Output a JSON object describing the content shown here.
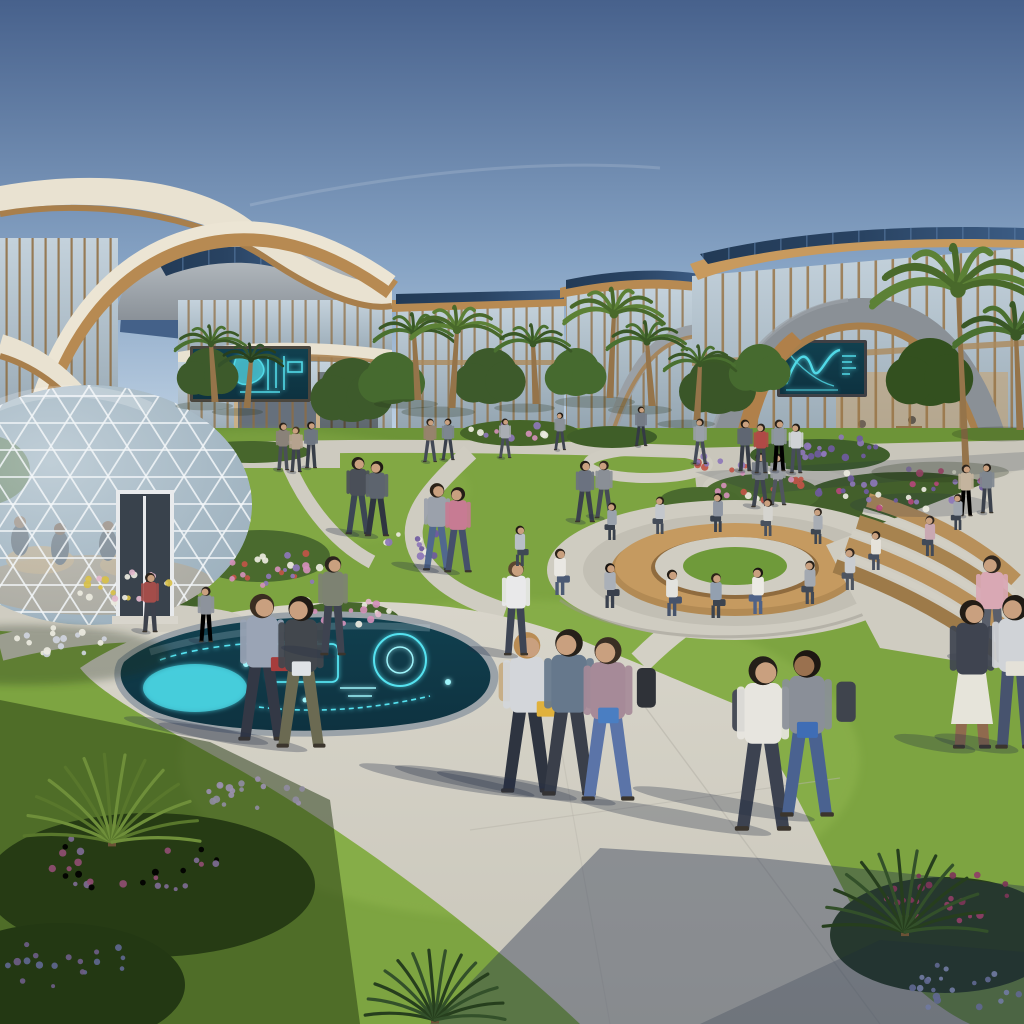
{
  "scene": {
    "alt": "Sunny futuristic university campus courtyard with curved wood-and-glass buildings, solar roofs, a geodesic glass dome, glowing cyan holographic displays, winding paths, a circular seating ring and students walking the green quad."
  },
  "palette": {
    "sky_top": "#47618c",
    "sky_mid": "#86a3c4",
    "sky_horizon": "#cdddeb",
    "wood": "#b78a52",
    "wood_dark": "#8f6a3c",
    "cream": "#e9e2d1",
    "roof_gray": "#a6acb2",
    "roof_gray_dark": "#878e95",
    "solar_dark": "#294362",
    "solar_line": "#55779f",
    "glass_light": "#c4d2dc",
    "glass_dark": "#93a4b0",
    "grass_sun": "#7da441",
    "grass_light": "#93b851",
    "grass_shade": "#3f5c24",
    "path_sun": "#d8d5ca",
    "path_mid": "#c7c4b9",
    "holo_bg": "#0e3240",
    "holo_cyan": "#55e2f0",
    "holo_bright": "#9ef4fb",
    "skin": "#c9a07f",
    "shadow_blue": "#232e44"
  },
  "people": [
    {
      "x": 527,
      "y": 792,
      "h": 162,
      "pose": "walk",
      "dir": 1,
      "top": "#d3d6da",
      "bottom": "#2e3440",
      "hair": "#b98c54",
      "item": "#e0b13c",
      "bag": "#c7ae86",
      "sh": 1
    },
    {
      "x": 569,
      "y": 795,
      "h": 168,
      "pose": "walk",
      "dir": -1,
      "top": "#66788c",
      "bottom": "#3a3f4a",
      "hair": "#26201a",
      "bag": "#3c4049",
      "sh": 1
    },
    {
      "x": 608,
      "y": 800,
      "h": 165,
      "pose": "walk",
      "dir": -1,
      "top": "#a68a98",
      "bottom": "#5b74a8",
      "hair": "#3a2e24",
      "item": "#4a7ec2",
      "bag": "#2f3238",
      "sh": 1
    },
    {
      "x": 763,
      "y": 830,
      "h": 176,
      "pose": "walk",
      "dir": 1,
      "top": "#e7e5df",
      "bottom": "#3c4250",
      "hair": "#241f19",
      "bag": "#474c57",
      "sh": 1
    },
    {
      "x": 807,
      "y": 816,
      "h": 168,
      "pose": "walk",
      "dir": -1,
      "top": "#8a8f98",
      "bottom": "#4a6290",
      "hair": "#1d1712",
      "skin": "#9a714f",
      "item": "#3f6db5",
      "bag": "#3f444d",
      "sh": 1
    },
    {
      "x": 262,
      "y": 740,
      "h": 148,
      "pose": "walk",
      "dir": 1,
      "top": "#9aa4b5",
      "bottom": "#333845",
      "hair": "#3a2d21",
      "item": "#a63c3c",
      "sh": 0.9
    },
    {
      "x": 301,
      "y": 747,
      "h": 153,
      "pose": "walk",
      "dir": -1,
      "top": "#42474d",
      "bottom": "#6b6a52",
      "hair": "#201b15",
      "item": "#dfe3e6",
      "sh": 0.9
    },
    {
      "x": 516,
      "y": 655,
      "h": 95,
      "pose": "stand",
      "dir": 1,
      "top": "#e9e9ea",
      "bottom": "#3e4554",
      "hair": "#5a4632",
      "sh": 0.5
    },
    {
      "x": 333,
      "y": 655,
      "h": 100,
      "pose": "stand",
      "dir": 1,
      "top": "#7d8272",
      "bottom": "#3e4350",
      "hair": "#2b241d",
      "sh": 0.5
    },
    {
      "x": 437,
      "y": 570,
      "h": 88,
      "pose": "walk",
      "dir": 1,
      "top": "#9ba1ab",
      "bottom": "#51688e",
      "hair": "#2a2118",
      "sh": 0.5
    },
    {
      "x": 458,
      "y": 572,
      "h": 86,
      "pose": "walk",
      "dir": -1,
      "top": "#c77b93",
      "bottom": "#45506b",
      "hair": "#241d17",
      "sh": 0.5
    },
    {
      "x": 358,
      "y": 534,
      "h": 78,
      "pose": "walk",
      "dir": 1,
      "top": "#4a4f58",
      "bottom": "#3c4654",
      "hair": "#241f18",
      "sh": 0.4
    },
    {
      "x": 377,
      "y": 536,
      "h": 76,
      "pose": "walk",
      "dir": -1,
      "top": "#5d646e",
      "bottom": "#2f3540",
      "hair": "#1f1a14",
      "sh": 0.4
    },
    {
      "x": 585,
      "y": 522,
      "h": 62,
      "pose": "walk",
      "dir": 1,
      "top": "#6b7280",
      "bottom": "#3b414c",
      "hair": "#221c15",
      "sh": 0.3
    },
    {
      "x": 604,
      "y": 518,
      "h": 58,
      "pose": "walk",
      "dir": -1,
      "top": "#8a8f96",
      "bottom": "#454b56",
      "hair": "#2c241c",
      "sh": 0.3
    },
    {
      "x": 760,
      "y": 507,
      "h": 55,
      "pose": "walk",
      "dir": 1,
      "top": "#7a8088",
      "bottom": "#3f454f",
      "hair": "#241e17",
      "sh": 0.3
    },
    {
      "x": 778,
      "y": 505,
      "h": 52,
      "pose": "walk",
      "dir": -1,
      "top": "#9a9ea4",
      "bottom": "#50555e",
      "hair": "#1d1812",
      "sh": 0.3
    },
    {
      "x": 283,
      "y": 470,
      "h": 48,
      "pose": "stand",
      "dir": 1,
      "top": "#8a8279",
      "bottom": "#4a4f58",
      "hair": "#2a231c",
      "sh": 0.2
    },
    {
      "x": 296,
      "y": 472,
      "h": 46,
      "pose": "stand",
      "dir": -1,
      "top": "#b5a28e",
      "bottom": "#3e434d",
      "hair": "#463724",
      "sh": 0.2
    },
    {
      "x": 311,
      "y": 468,
      "h": 47,
      "pose": "stand",
      "dir": 1,
      "top": "#6e7681",
      "bottom": "#383e48",
      "hair": "#211b14",
      "sh": 0.2
    },
    {
      "x": 430,
      "y": 462,
      "h": 44,
      "pose": "walk",
      "dir": 1,
      "top": "#97836d",
      "bottom": "#434956",
      "hair": "#2e251b",
      "sh": 0.2
    },
    {
      "x": 448,
      "y": 460,
      "h": 42,
      "pose": "walk",
      "dir": -1,
      "top": "#7d8690",
      "bottom": "#3a404b",
      "hair": "#241e16",
      "sh": 0.2
    },
    {
      "x": 505,
      "y": 458,
      "h": 40,
      "pose": "walk",
      "dir": 1,
      "top": "#a9adb3",
      "bottom": "#474d58",
      "hair": "#2a2119",
      "sh": 0.2
    },
    {
      "x": 560,
      "y": 450,
      "h": 38,
      "pose": "walk",
      "dir": -1,
      "top": "#8b9199",
      "bottom": "#3f4450",
      "hair": "#1f1913",
      "sh": 0.15
    },
    {
      "x": 641,
      "y": 446,
      "h": 40,
      "pose": "walk",
      "dir": 1,
      "top": "#747b85",
      "bottom": "#343a44",
      "hair": "#241d16",
      "sh": 0.15
    },
    {
      "x": 700,
      "y": 464,
      "h": 46,
      "pose": "walk",
      "dir": -1,
      "top": "#9aa0a8",
      "bottom": "#454b57",
      "hair": "#2b231b",
      "sh": 0.2
    },
    {
      "x": 745,
      "y": 471,
      "h": 52,
      "pose": "stand",
      "dir": 1,
      "top": "#5f6672",
      "bottom": "#363c46",
      "hair": "#201a13",
      "sh": 0.2
    },
    {
      "x": 761,
      "y": 473,
      "h": 50,
      "pose": "stand",
      "dir": -1,
      "top": "#b04a46",
      "bottom": "#3e444f",
      "hair": "#2c241c",
      "sh": 0.2
    },
    {
      "x": 779,
      "y": 471,
      "h": 52,
      "pose": "stand",
      "dir": 1,
      "top": "#8e96a0",
      "bottom": "#40465二",
      "sh": 0.2
    },
    {
      "x": 796,
      "y": 473,
      "h": 50,
      "pose": "stand",
      "dir": -1,
      "top": "#cfd2d5",
      "bottom": "#474d59",
      "hair": "#241e17",
      "sh": 0.2
    },
    {
      "x": 150,
      "y": 632,
      "h": 60,
      "pose": "stand",
      "dir": 1,
      "top": "#a34d4a",
      "bottom": "#3c414c",
      "hair": "#2b231b",
      "sh": 0.3
    },
    {
      "x": 206,
      "y": 642,
      "h": 56,
      "pose": "stand",
      "dir": -1,
      "top": "#8d939c",
      "bottom": "#42485三",
      "sh": 0.3
    },
    {
      "x": 992,
      "y": 662,
      "h": 108,
      "pose": "stand",
      "dir": -1,
      "top": "#d9a8b4",
      "bottom": "#5a5f6b",
      "hair": "#2f2720",
      "sh": 0.4
    },
    {
      "x": 972,
      "y": 748,
      "h": 150,
      "pose": "stand",
      "dir": 1,
      "top": "#3f4450",
      "bottom": "#8f6a4e",
      "hair": "#231c15",
      "skirt": true,
      "skirtColor": "#e6e4da",
      "sh": 0.5
    },
    {
      "x": 1015,
      "y": 748,
      "h": 155,
      "pose": "stand",
      "dir": -1,
      "top": "#d0d3d7",
      "bottom": "#47536e",
      "hair": "#1f1b15",
      "item": "#e4e1d8",
      "sh": 0.5
    },
    {
      "x": 966,
      "y": 516,
      "h": 52,
      "pose": "stand",
      "dir": 1,
      "top": "#c4b49e",
      "bottom": "#42485三",
      "sh": 0.2
    },
    {
      "x": 987,
      "y": 513,
      "h": 50,
      "pose": "stand",
      "dir": -1,
      "top": "#7f8790",
      "bottom": "#3b414c",
      "hair": "#261f18",
      "sh": 0.2
    },
    {
      "x": 560,
      "y": 595,
      "h": 62,
      "pose": "sit",
      "dir": 1,
      "top": "#e9e7e2",
      "bottom": "#4c5a74",
      "hair": "#2a2119"
    },
    {
      "x": 610,
      "y": 608,
      "h": 60,
      "pose": "sit",
      "dir": 1,
      "top": "#aab0b8",
      "bottom": "#39404d",
      "hair": "#171310"
    },
    {
      "x": 672,
      "y": 616,
      "h": 62,
      "pose": "sit",
      "dir": 1,
      "top": "#e2e2de",
      "bottom": "#46536b",
      "hair": "#241d16"
    },
    {
      "x": 716,
      "y": 618,
      "h": 60,
      "pose": "sit",
      "dir": 1,
      "top": "#93a0b0",
      "bottom": "#3c444f",
      "hair": "#2c2218"
    },
    {
      "x": 758,
      "y": 614,
      "h": 62,
      "pose": "sit",
      "dir": -1,
      "top": "#eceae4",
      "bottom": "#4f6287",
      "hair": "#1c1713"
    },
    {
      "x": 810,
      "y": 604,
      "h": 58,
      "pose": "sit",
      "dir": -1,
      "top": "#a3a9b1",
      "bottom": "#424a56",
      "hair": "#241e18"
    },
    {
      "x": 850,
      "y": 590,
      "h": 56,
      "pose": "sit",
      "dir": -1,
      "top": "#c9ccd0",
      "bottom": "#4e5560",
      "hair": "#2f2620"
    },
    {
      "x": 876,
      "y": 570,
      "h": 52,
      "pose": "sit",
      "dir": -1,
      "top": "#e5e2da",
      "bottom": "#475060",
      "hair": "#241d17"
    },
    {
      "x": 520,
      "y": 566,
      "h": 54,
      "pose": "sit",
      "dir": 1,
      "top": "#b9bfc7",
      "bottom": "#3f4854",
      "hair": "#221b15"
    },
    {
      "x": 612,
      "y": 540,
      "h": 50,
      "pose": "sit",
      "dir": -1,
      "top": "#9aa2ac",
      "bottom": "#39414c",
      "hair": "#1f1913"
    },
    {
      "x": 660,
      "y": 534,
      "h": 50,
      "pose": "sit",
      "dir": -1,
      "top": "#c3c7cc",
      "bottom": "#444c58",
      "hair": "#2a221a"
    },
    {
      "x": 718,
      "y": 532,
      "h": 52,
      "pose": "sit",
      "dir": -1,
      "top": "#8f96a2",
      "bottom": "#3a424e",
      "hair": "#17120e"
    },
    {
      "x": 768,
      "y": 536,
      "h": 50,
      "pose": "sit",
      "dir": -1,
      "top": "#d5d4cf",
      "bottom": "#49515e",
      "hair": "#241e17"
    },
    {
      "x": 818,
      "y": 544,
      "h": 48,
      "pose": "sit",
      "dir": -1,
      "top": "#a8adb4",
      "bottom": "#3e4651",
      "hair": "#2b231b"
    },
    {
      "x": 930,
      "y": 556,
      "h": 54,
      "pose": "sit",
      "dir": -1,
      "top": "#c9a8b2",
      "bottom": "#414a58",
      "hair": "#2f2721"
    },
    {
      "x": 958,
      "y": 530,
      "h": 48,
      "pose": "sit",
      "dir": -1,
      "top": "#9fa6ae",
      "bottom": "#3c4450",
      "hair": "#221c15"
    }
  ],
  "palms": [
    {
      "x": 418,
      "y": 400,
      "h": 66,
      "r": 40,
      "lean": -4,
      "tone": "mid"
    },
    {
      "x": 452,
      "y": 408,
      "h": 78,
      "r": 46,
      "lean": 5,
      "tone": "light"
    },
    {
      "x": 536,
      "y": 404,
      "h": 60,
      "r": 38,
      "lean": -3,
      "tone": "mid"
    },
    {
      "x": 610,
      "y": 398,
      "h": 84,
      "r": 50,
      "lean": 4,
      "tone": "light"
    },
    {
      "x": 652,
      "y": 406,
      "h": 64,
      "r": 40,
      "lean": -5,
      "tone": "mid"
    },
    {
      "x": 697,
      "y": 420,
      "h": 56,
      "r": 36,
      "lean": 3,
      "tone": "mid"
    },
    {
      "x": 215,
      "y": 402,
      "h": 58,
      "r": 36,
      "lean": -4,
      "tone": "mid"
    },
    {
      "x": 247,
      "y": 408,
      "h": 48,
      "r": 32,
      "lean": 4,
      "tone": "dark"
    },
    {
      "x": 966,
      "y": 468,
      "h": 178,
      "r": 86,
      "lean": -8,
      "tone": "light"
    },
    {
      "x": 1020,
      "y": 430,
      "h": 95,
      "r": 62,
      "lean": -4,
      "tone": "mid"
    }
  ],
  "fan_palms": [
    {
      "x": 112,
      "y": 842,
      "r": 88,
      "tone": "lit"
    },
    {
      "x": 905,
      "y": 932,
      "r": 82,
      "tone": "dark"
    },
    {
      "x": 435,
      "y": 1020,
      "r": 70,
      "tone": "dark"
    }
  ],
  "trees": [
    {
      "x": 352,
      "y": 390,
      "r": 32,
      "tone": "#3d5a2b"
    },
    {
      "x": 392,
      "y": 378,
      "r": 26,
      "tone": "#466a2f"
    },
    {
      "x": 490,
      "y": 376,
      "r": 28,
      "tone": "#3d5a2b"
    },
    {
      "x": 576,
      "y": 372,
      "r": 24,
      "tone": "#466a2f"
    },
    {
      "x": 718,
      "y": 384,
      "r": 30,
      "tone": "#3a5628"
    },
    {
      "x": 760,
      "y": 368,
      "r": 24,
      "tone": "#466a2f"
    },
    {
      "x": 208,
      "y": 372,
      "r": 24,
      "tone": "#3d5a2b"
    },
    {
      "x": 930,
      "y": 372,
      "r": 34,
      "tone": "#33501f"
    }
  ],
  "bushes": [
    {
      "x": 260,
      "y": 556,
      "rx": 70,
      "ry": 26,
      "c": "#4a6a2e"
    },
    {
      "x": 120,
      "y": 602,
      "rx": 80,
      "ry": 28,
      "c": "#42612a"
    },
    {
      "x": 905,
      "y": 500,
      "rx": 105,
      "ry": 28,
      "c": "#435f2b"
    },
    {
      "x": 762,
      "y": 494,
      "rx": 58,
      "ry": 20,
      "c": "#4c6c30"
    },
    {
      "x": 820,
      "y": 455,
      "rx": 70,
      "ry": 16,
      "c": "#3f5e2b"
    },
    {
      "x": 520,
      "y": 433,
      "rx": 60,
      "ry": 13,
      "c": "#456428"
    },
    {
      "x": 612,
      "y": 437,
      "rx": 45,
      "ry": 11,
      "c": "#3f5e28"
    },
    {
      "x": 250,
      "y": 452,
      "rx": 60,
      "ry": 11,
      "c": "#47662c"
    },
    {
      "x": 345,
      "y": 620,
      "rx": 55,
      "ry": 18,
      "c": "#47662c"
    },
    {
      "x": 150,
      "y": 885,
      "rx": 165,
      "ry": 72,
      "c": "#2a4019"
    },
    {
      "x": 60,
      "y": 985,
      "rx": 125,
      "ry": 62,
      "c": "#243a17"
    },
    {
      "x": 945,
      "y": 935,
      "rx": 115,
      "ry": 58,
      "c": "#273d19"
    },
    {
      "x": 700,
      "y": 500,
      "rx": 40,
      "ry": 13,
      "c": "#4a6a2e"
    }
  ],
  "flower_clusters": [
    {
      "x": 285,
      "y": 570,
      "rx": 58,
      "ry": 22,
      "n": 26,
      "c": [
        "#8d77b8",
        "#d290b8",
        "#eceadf",
        "#c05548"
      ]
    },
    {
      "x": 347,
      "y": 608,
      "rx": 46,
      "ry": 17,
      "n": 20,
      "c": [
        "#d290b8",
        "#eceadf",
        "#e3b7cc"
      ]
    },
    {
      "x": 120,
      "y": 586,
      "rx": 52,
      "ry": 18,
      "n": 22,
      "c": [
        "#eceadf",
        "#e3b7cc",
        "#d8c04a"
      ]
    },
    {
      "x": 58,
      "y": 640,
      "rx": 48,
      "ry": 16,
      "n": 16,
      "c": [
        "#eceadf",
        "#cfd4de"
      ]
    },
    {
      "x": 420,
      "y": 545,
      "rx": 38,
      "ry": 13,
      "n": 14,
      "c": [
        "#8d77b8",
        "#6f5ba0",
        "#eceadf"
      ]
    },
    {
      "x": 905,
      "y": 490,
      "rx": 92,
      "ry": 22,
      "n": 34,
      "c": [
        "#8d77b8",
        "#b5487a",
        "#eceadf",
        "#6f5ba0"
      ]
    },
    {
      "x": 762,
      "y": 486,
      "rx": 50,
      "ry": 15,
      "n": 18,
      "c": [
        "#d290b8",
        "#c05548",
        "#eceadf"
      ]
    },
    {
      "x": 838,
      "y": 448,
      "rx": 55,
      "ry": 12,
      "n": 18,
      "c": [
        "#8d77b8",
        "#6f5ba0"
      ]
    },
    {
      "x": 726,
      "y": 462,
      "rx": 36,
      "ry": 11,
      "n": 12,
      "c": [
        "#c05548",
        "#8d77b8"
      ]
    },
    {
      "x": 512,
      "y": 430,
      "rx": 42,
      "ry": 10,
      "n": 12,
      "c": [
        "#d290b8",
        "#8d77b8",
        "#eceadf"
      ]
    },
    {
      "x": 135,
      "y": 862,
      "rx": 85,
      "ry": 36,
      "n": 30,
      "c": [
        "#8f4e72",
        "#a univers6b8e",
        "#7d6b93"
      ]
    },
    {
      "x": 255,
      "y": 800,
      "rx": 60,
      "ry": 24,
      "n": 18,
      "c": [
        "#9a8fae",
        "#8f8ba0"
      ]
    },
    {
      "x": 62,
      "y": 962,
      "rx": 65,
      "ry": 30,
      "n": 18,
      "c": [
        "#5f678f",
        "#6d5d86"
      ]
    },
    {
      "x": 952,
      "y": 898,
      "rx": 66,
      "ry": 26,
      "n": 22,
      "c": [
        "#8f3e66",
        "#7d3558"
      ]
    },
    {
      "x": 966,
      "y": 988,
      "rx": 62,
      "ry": 26,
      "n": 20,
      "c": [
        "#5f678f",
        "#707aa0"
      ]
    }
  ]
}
